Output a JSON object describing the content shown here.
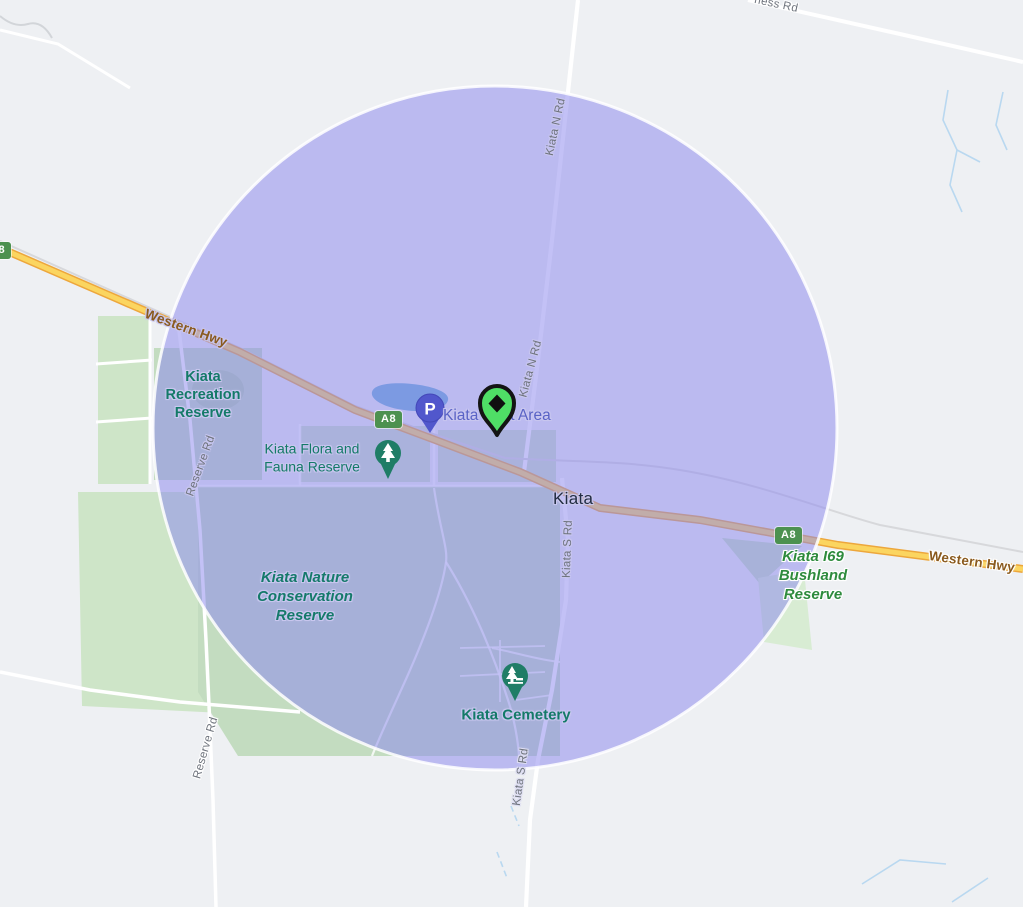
{
  "map": {
    "kind": "road-map with radius circle overlay",
    "labels": {
      "town": "Kiata",
      "rest_area": "Kiata Rest Area",
      "recreation": "Kiata\nRecreation\nReserve",
      "flora_fauna": "Kiata Flora and\nFauna Reserve",
      "nature_conservation": "Kiata Nature\nConservation\nReserve",
      "i69_bushland": "Kiata I69\nBushland\nReserve",
      "cemetery": "Kiata Cemetery",
      "western_hwy": "Western Hwy",
      "kiata_n_rd": "Kiata N Rd",
      "kiata_s_rd": "Kiata S Rd",
      "reserve_rd": "Reserve Rd",
      "ness_rd": "ness Rd",
      "route_shield": "A8",
      "parking_glyph": "P"
    },
    "icons": {
      "main_marker": "diamond-pin-icon",
      "parking_pin": "parking-icon",
      "flora_pin": "tree-icon",
      "cemetery_pin": "tree-icon"
    },
    "colors": {
      "background": "#eef0f3",
      "circle_fill": "#8c88ee",
      "circle_fill_opacity": 0.52,
      "circle_border": "#ffffff",
      "highway_fill": "#fbd560",
      "highway_casing": "#eda73c",
      "field_green": "#cee5c8",
      "reserve_green": "#c3dcc0",
      "water_blue": "#7fb0f4",
      "stream_blue": "#b9d8f0",
      "park_label": "#147a68",
      "bushland_label": "#2e8b3d",
      "road_label": "#6f747d",
      "highway_label": "#8a5a1e",
      "town_label": "#222d42",
      "rest_area_label": "#5a63c6",
      "marker_green": "#4fdf66",
      "marker_outline": "#141414",
      "parking_blue": "#5157cc",
      "tree_pin_green": "#1f7d66",
      "shield_green": "#4c9150"
    }
  }
}
